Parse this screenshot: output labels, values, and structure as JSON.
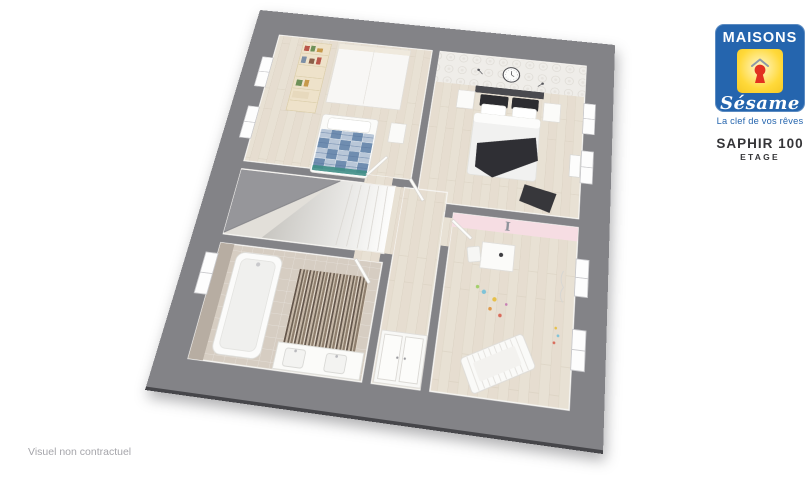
{
  "page": {
    "background_color": "#ffffff"
  },
  "logo": {
    "brand_name": "MAISONS",
    "brand_script": "Sésame",
    "tagline": "La clef de vos rêves",
    "colors": {
      "blue": "#2565ae",
      "yellow": "#ffd42e",
      "red": "#e23120"
    }
  },
  "plan_header": {
    "model_name": "SAPHIR 100",
    "floor_label": "ETAGE"
  },
  "footer": {
    "disclaimer": "Visuel non contractuel"
  },
  "floorplan": {
    "wall_letter": "I",
    "colors": {
      "frame_gray": "#838387",
      "wood_floor": "#e8e1d4",
      "bathroom_floor": "#d6cdc2",
      "kids_pink_wall": "#f6dde3",
      "bed_plaid_blue": "#6f8db0",
      "master_bed_dark": "#2f2f34",
      "stair_slope_gray": "#96969a"
    }
  }
}
